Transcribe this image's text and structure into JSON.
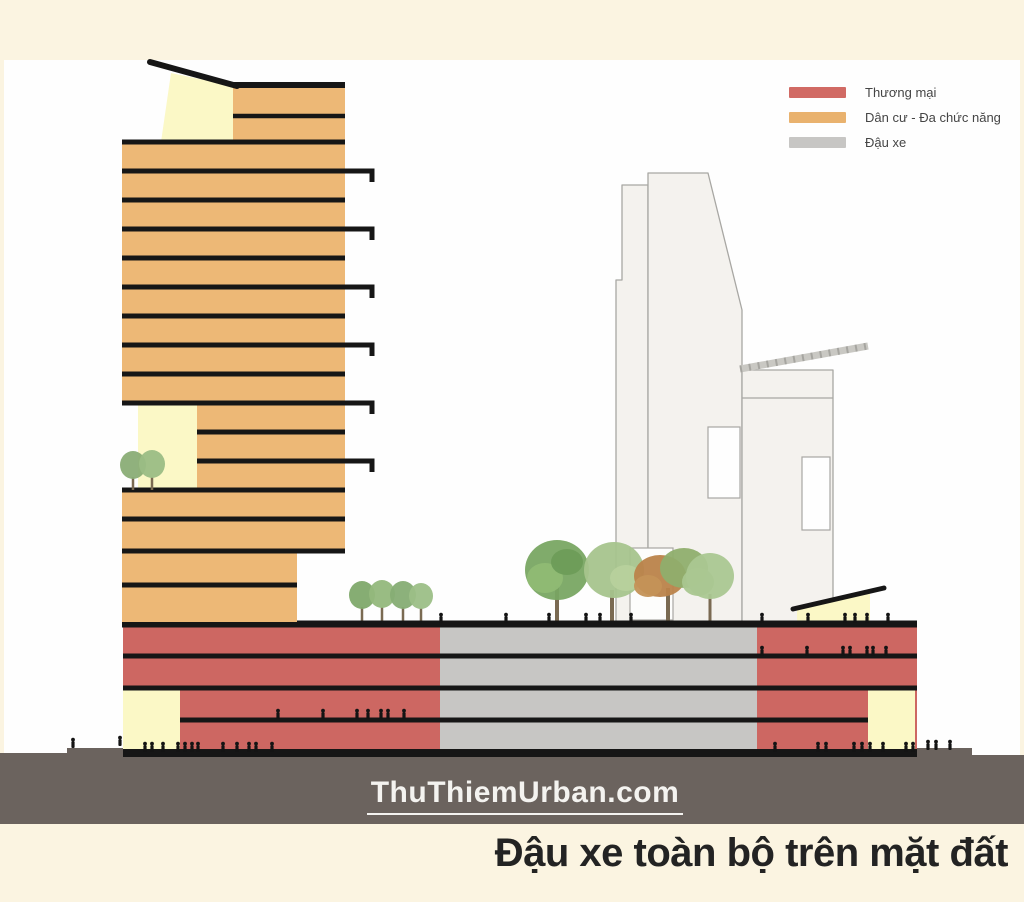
{
  "diagram": {
    "caption": "Đậu xe toàn bộ trên mặt đất",
    "watermark": "ThuThiemUrban.com"
  },
  "legend": {
    "items": [
      {
        "label": "Thương mại",
        "color": "#d16a64"
      },
      {
        "label": "Dân cư - Đa chức năng",
        "color": "#e9b26e"
      },
      {
        "label": "Đậu xe",
        "color": "#c7c6c4"
      }
    ]
  },
  "palette": {
    "background": "#fbf4e1",
    "panel": "#fefefe",
    "commercial_red": "#cd6762",
    "residential_orange": "#edb876",
    "parking_gray": "#c7c6c4",
    "accent_pale_yellow": "#fbf8c6",
    "ground_dark": "#6b635e",
    "line_black": "#161616",
    "background_building_fill": "#f4f2ee",
    "background_building_stroke": "#a8a7a3",
    "caption_text": "#232323",
    "watermark_text": "#f4f3f0"
  }
}
